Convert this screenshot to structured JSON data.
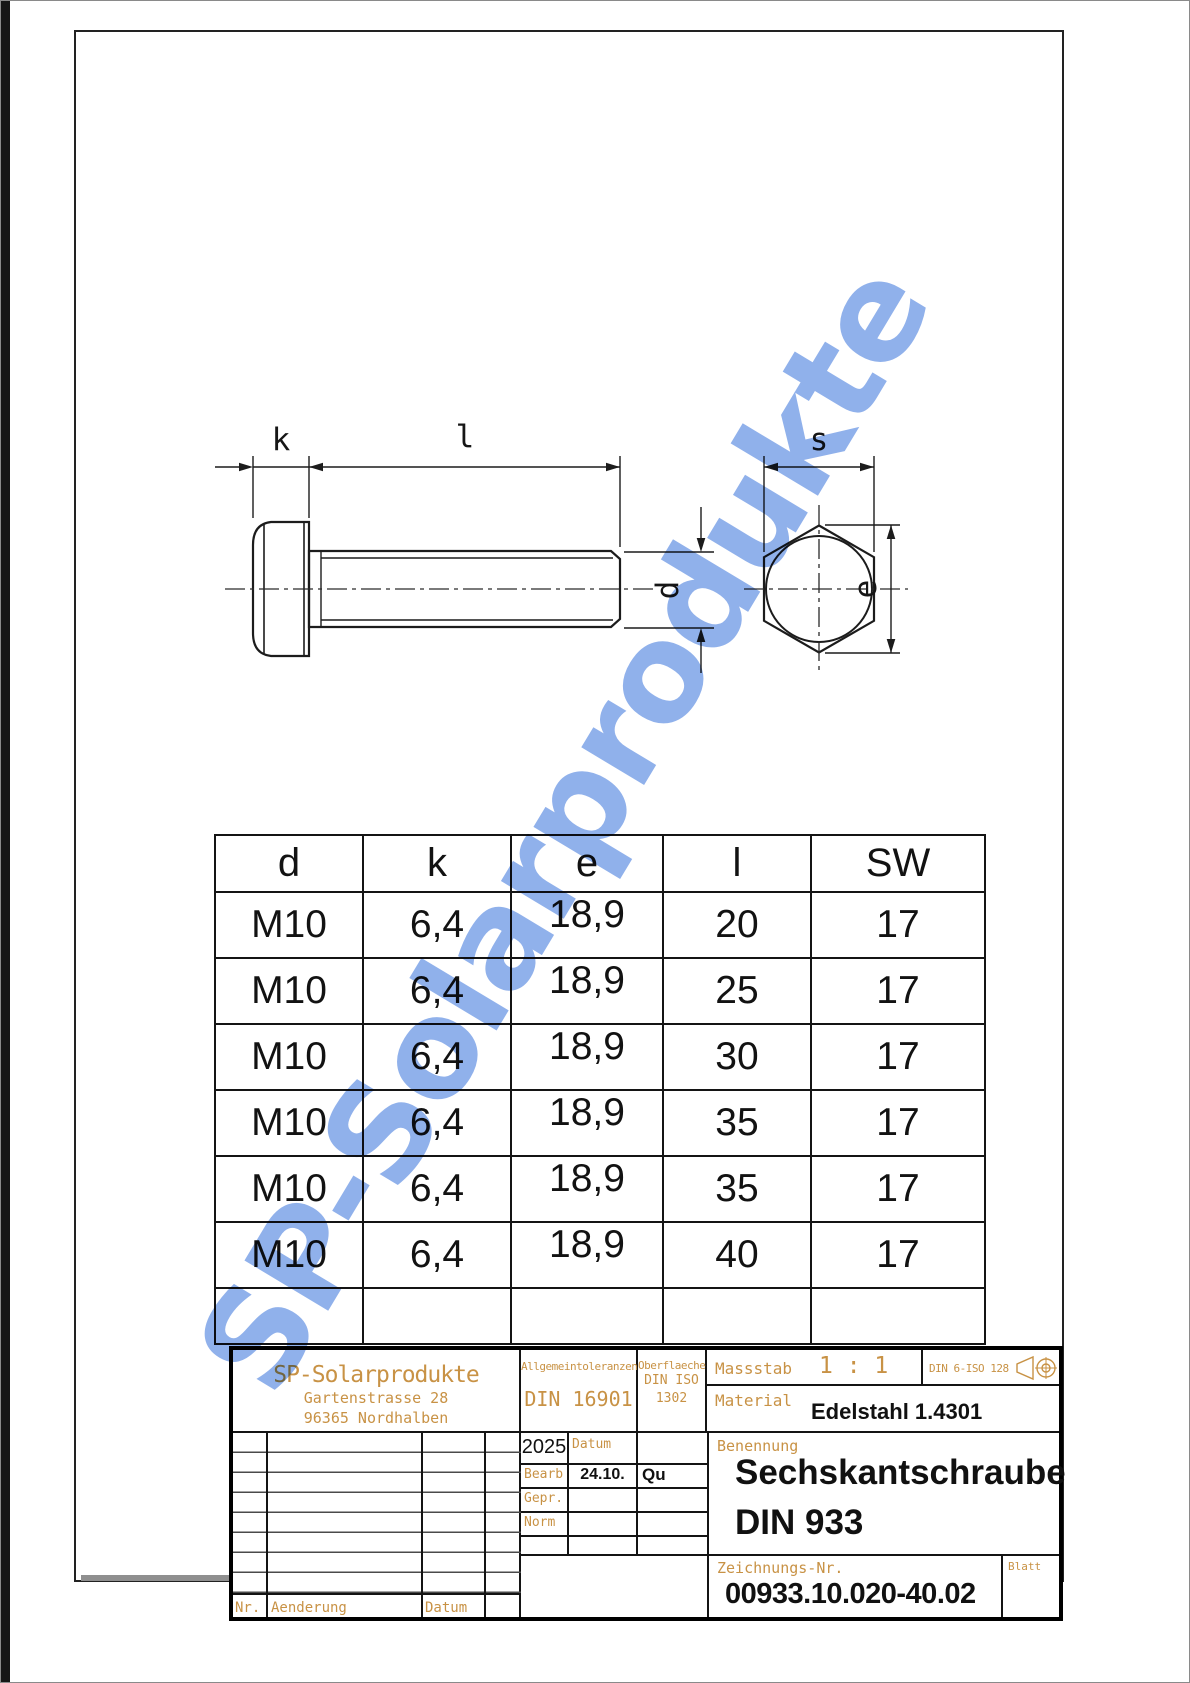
{
  "watermark_text": "SP-Solarprodukte",
  "drawing": {
    "labels": {
      "k": "k",
      "l": "l",
      "s": "s",
      "d": "d",
      "e": "e"
    }
  },
  "table": {
    "headers": [
      "d",
      "k",
      "e",
      "l",
      "SW"
    ],
    "rows": [
      [
        "M10",
        "6,4",
        "18,9",
        "20",
        "17"
      ],
      [
        "M10",
        "6,4",
        "18,9",
        "25",
        "17"
      ],
      [
        "M10",
        "6,4",
        "18,9",
        "30",
        "17"
      ],
      [
        "M10",
        "6,4",
        "18,9",
        "35",
        "17"
      ],
      [
        "M10",
        "6,4",
        "18,9",
        "35",
        "17"
      ],
      [
        "M10",
        "6,4",
        "18,9",
        "40",
        "17"
      ]
    ]
  },
  "title_block": {
    "company": {
      "name": "SP-Solarprodukte",
      "address1": "Gartenstrasse 28",
      "address2": "96365 Nordhalben"
    },
    "tolerances": {
      "label": "Allgemeintoleranzen",
      "value": "DIN 16901"
    },
    "surface": {
      "label": "Oberflaeche",
      "line1": "DIN ISO",
      "line2": "1302"
    },
    "scale": {
      "label": "Massstab",
      "value": "1 : 1"
    },
    "projection": {
      "standard": "DIN 6-ISO 128"
    },
    "material": {
      "label": "Material",
      "value": "Edelstahl 1.4301"
    },
    "approvals": {
      "year": "2025",
      "date_header": "Datum",
      "rows": [
        {
          "label": "Bearb",
          "date": "24.10.",
          "name": "Qu"
        },
        {
          "label": "Gepr.",
          "date": "",
          "name": ""
        },
        {
          "label": "Norm",
          "date": "",
          "name": ""
        }
      ]
    },
    "designation": {
      "label": "Benennung",
      "line1": "Sechskantschraube",
      "line2": "DIN 933"
    },
    "drawing_number": {
      "label": "Zeichnungs-Nr.",
      "value": "00933.10.020-40.02"
    },
    "sheet_label": "Blatt",
    "revision": {
      "nr_label": "Nr.",
      "change_label": "Aenderung",
      "date_label": "Datum"
    }
  },
  "colors": {
    "cad_orange": "#c89245",
    "watermark_blue": "#7da3e8",
    "line_black": "#1c1c1c"
  }
}
